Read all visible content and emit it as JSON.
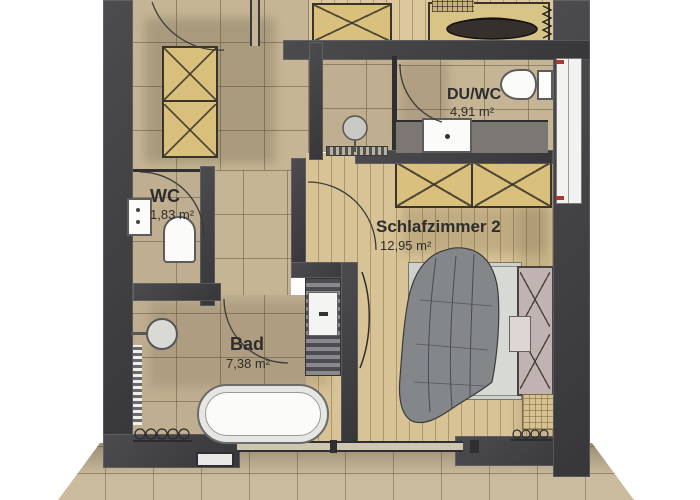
{
  "plan": {
    "type": "floor-plan",
    "rooms": [
      {
        "name": "WC",
        "area": "1,83 m²"
      },
      {
        "name": "DU/WC",
        "area": "4,91 m²"
      },
      {
        "name": "Schlafzimmer 2",
        "area": "12,95 m²"
      },
      {
        "name": "Bad",
        "area": "7,38 m²"
      }
    ],
    "colors": {
      "wall": "#3f3f41",
      "tile_floor": "#c6b595",
      "wood_floor": "#d8c396",
      "terrace": "#cbbc9d",
      "furniture_wood": "#d9c07c",
      "blanket": "#84878a",
      "headboard": "#c1b3b1",
      "window_mark_red": "#a93a32",
      "text": "#2d2d2d"
    }
  }
}
